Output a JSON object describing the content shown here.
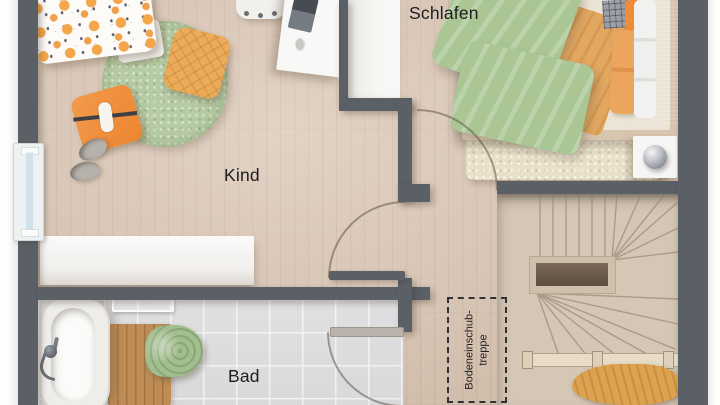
{
  "plan": {
    "rooms": [
      {
        "id": "schlafen",
        "label": "Schlafen"
      },
      {
        "id": "kind",
        "label": "Kind"
      },
      {
        "id": "bad",
        "label": "Bad"
      }
    ],
    "annotation": {
      "attic_ladder_line1": "Bodeneinschub-",
      "attic_ladder_line2": "treppe"
    }
  },
  "colors": {
    "wall": "#5b6067",
    "floor_wood": "#dbc8b7",
    "bath_tile": "#e3e6e9",
    "stair_wood": "#d4c7b6",
    "accent_orange": "#ef9140",
    "accent_green": "#a9c795",
    "label_text": "#1d1d20"
  },
  "furniture": [
    "child-floor-cushion",
    "round-rug",
    "quilted-pillow",
    "doll-pillow",
    "slippers",
    "desk",
    "desk-chair",
    "sideboard",
    "wardrobe",
    "double-bed",
    "bed-rug",
    "nightstand",
    "table-lamp",
    "bathtub",
    "hand-shower",
    "bath-mat",
    "towel",
    "towel-bar",
    "winder-staircase",
    "stair-railing",
    "blanket"
  ]
}
